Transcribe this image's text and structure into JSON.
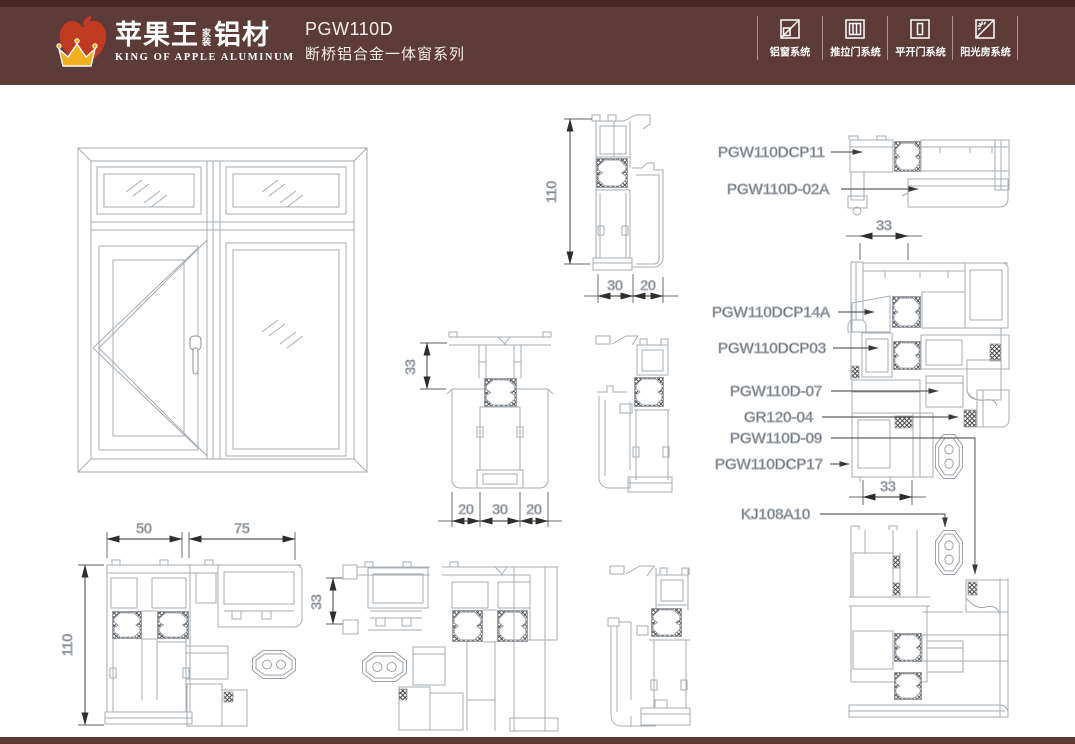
{
  "header": {
    "brand_cn": "苹果王",
    "brand_stack_top": "家",
    "brand_stack_bottom": "装",
    "brand_suffix": "铝材",
    "brand_en": "KING OF APPLE ALUMINUM",
    "model": "PGW110D",
    "series": "断桥铝合金一体窗系列",
    "systems": [
      {
        "label": "铝窗系统",
        "icon": "aluminum-window-system-icon"
      },
      {
        "label": "推拉门系统",
        "icon": "sliding-door-system-icon"
      },
      {
        "label": "平开门系统",
        "icon": "casement-door-system-icon"
      },
      {
        "label": "阳光房系统",
        "icon": "sunroom-system-icon"
      }
    ]
  },
  "labels": {
    "p11": "PGW110DCP11",
    "p02a": "PGW110D-02A",
    "p14a": "PGW110DCP14A",
    "p03": "PGW110DCP03",
    "p07": "PGW110D-07",
    "gr": "GR120-04",
    "p09": "PGW110D-09",
    "p17": "PGW110DCP17",
    "kj": "KJ108A10"
  },
  "dims": {
    "v110_top": "110",
    "h30": "30",
    "h20": "20",
    "h33_rt": "33",
    "h33_rb": "33",
    "v33_center": "33",
    "h20a": "20",
    "h30b": "30",
    "h20b": "20",
    "h50": "50",
    "h75": "75",
    "v110_bl": "110",
    "v33_bm": "33"
  },
  "colors": {
    "header_bg": "#5d3b39",
    "header_strip": "#472927",
    "apple_red": "#c03a21",
    "crown_gold": "#f2b11c",
    "text_white": "#ffffff",
    "profile_line": "#a7adb3",
    "annotation": "#1c1c1c"
  }
}
